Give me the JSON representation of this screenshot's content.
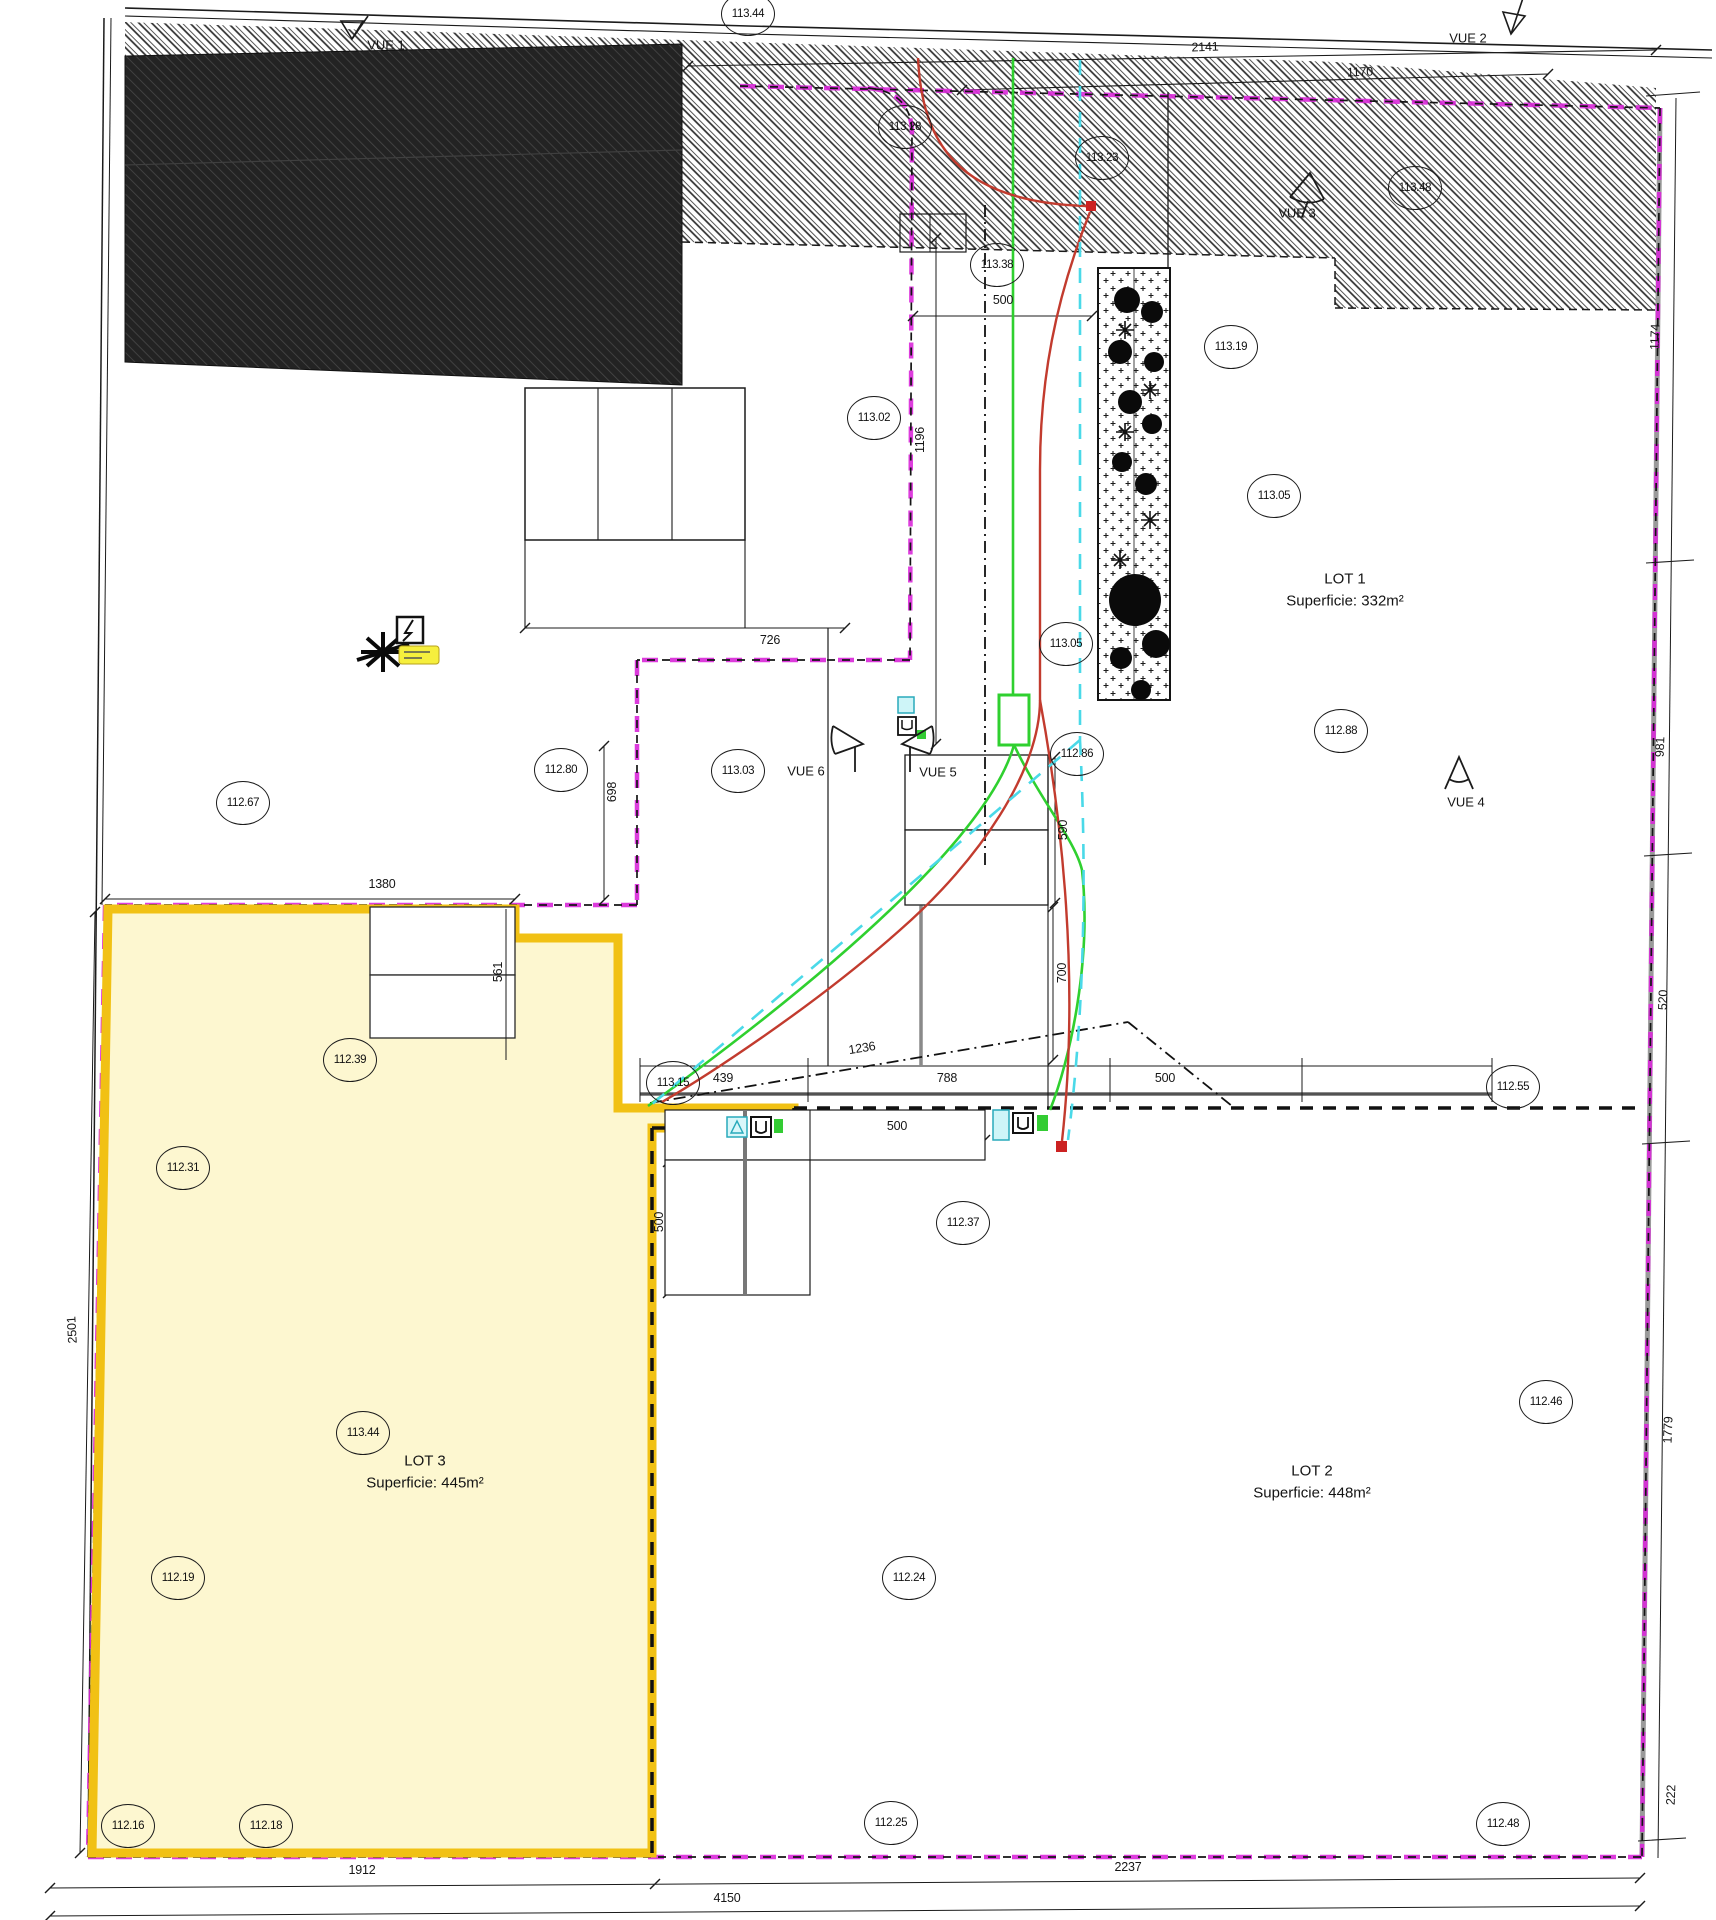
{
  "plan": {
    "lots": {
      "lot1": {
        "name": "LOT 1",
        "area": "Superficie: 332m²"
      },
      "lot2": {
        "name": "LOT 2",
        "area": "Superficie: 448m²"
      },
      "lot3": {
        "name": "LOT 3",
        "area": "Superficie: 445m²"
      }
    },
    "vues": {
      "v1": "VUE 1",
      "v2": "VUE 2",
      "v3": "VUE 3",
      "v4": "VUE 4",
      "v5": "VUE 5",
      "v6": "VUE 6"
    },
    "elevations": [
      "113.44",
      "113.28",
      "113.23",
      "113.48",
      "113.38",
      "113.19",
      "113.02",
      "113.05",
      "113.05",
      "112.88",
      "112.86",
      "113.03",
      "112.80",
      "112.67",
      "112.39",
      "112.31",
      "113.15",
      "112.55",
      "112.37",
      "113.44",
      "112.19",
      "112.46",
      "112.24",
      "112.16",
      "112.18",
      "112.25",
      "112.48"
    ],
    "dimensions": [
      "2141",
      "1170",
      "500",
      "1196",
      "726",
      "698",
      "1380",
      "561",
      "439",
      "1236",
      "788",
      "500",
      "700",
      "590",
      "500",
      "500",
      "1912",
      "2237",
      "4150",
      "2501",
      "1174",
      "981",
      "520",
      "1779",
      "222"
    ],
    "colors": {
      "boundary_magenta": "#d928d9",
      "lot3_fill": "#fdf7d0",
      "lot3_border": "#f1c114",
      "utility_green": "#2fd02f",
      "utility_red": "#c23b2e",
      "utility_cyan": "#4ad9e8",
      "building_dark": "#232323"
    }
  }
}
